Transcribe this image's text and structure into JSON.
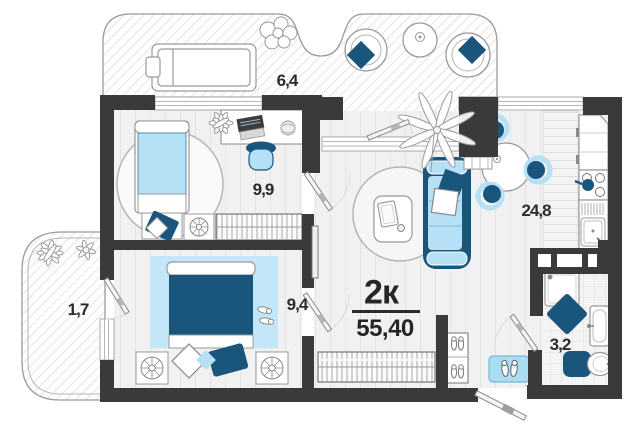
{
  "plan": {
    "apartment_type": "2к",
    "total_area": "55,40",
    "rooms": [
      {
        "id": "terrace",
        "area": "6,4"
      },
      {
        "id": "bedroom-1",
        "area": "9,9"
      },
      {
        "id": "bedroom-2",
        "area": "9,4"
      },
      {
        "id": "living-kitchen",
        "area": "24,8"
      },
      {
        "id": "bathroom",
        "area": "3,2"
      },
      {
        "id": "balcony",
        "area": "1,7"
      }
    ],
    "colors": {
      "accent_navy": "#1a567c",
      "accent_light_blue": "#b5e0f6",
      "wall_dark": "#3a3a3c",
      "label_text": "#2c2c2c"
    }
  }
}
